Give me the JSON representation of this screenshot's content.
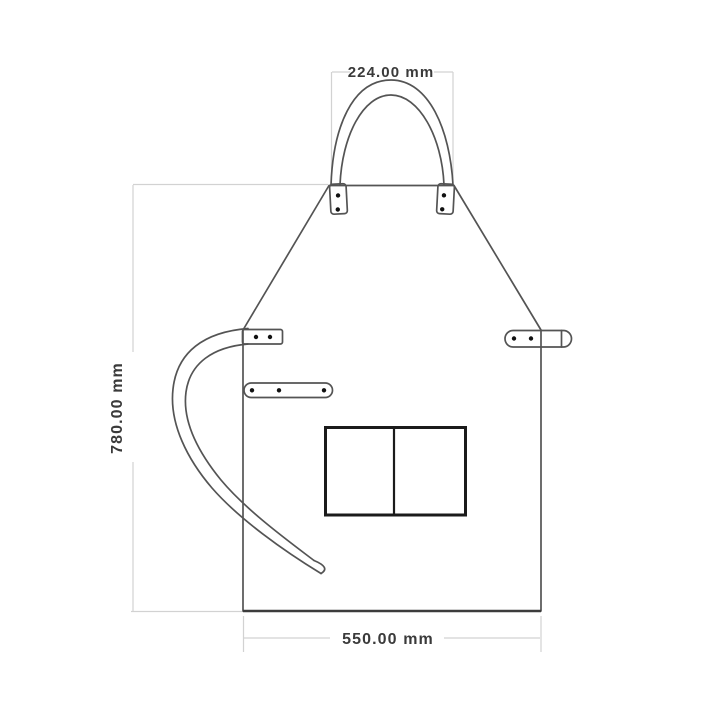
{
  "diagram": {
    "type": "technical-dimension-drawing",
    "subject": "apron",
    "dimensions": {
      "neck_strap_width": {
        "label": "224.00 mm",
        "value": 224.0,
        "unit": "mm"
      },
      "height": {
        "label": "780.00 mm",
        "value": 780.0,
        "unit": "mm"
      },
      "bottom_width": {
        "label": "550.00 mm",
        "value": 550.0,
        "unit": "mm"
      }
    },
    "colors": {
      "background": "#ffffff",
      "outline": "#545454",
      "pocket_outline": "#1b1b1b",
      "rivet": "#111111",
      "dimension_line": "#d2d2d2",
      "dimension_text": "#3a3a3a"
    },
    "parts": [
      "neck-strap-loop",
      "bib-panel",
      "double-pocket",
      "left-waist-strap-tab",
      "right-waist-strap-tab",
      "three-rivet-tab",
      "curved-waist-strap"
    ]
  }
}
